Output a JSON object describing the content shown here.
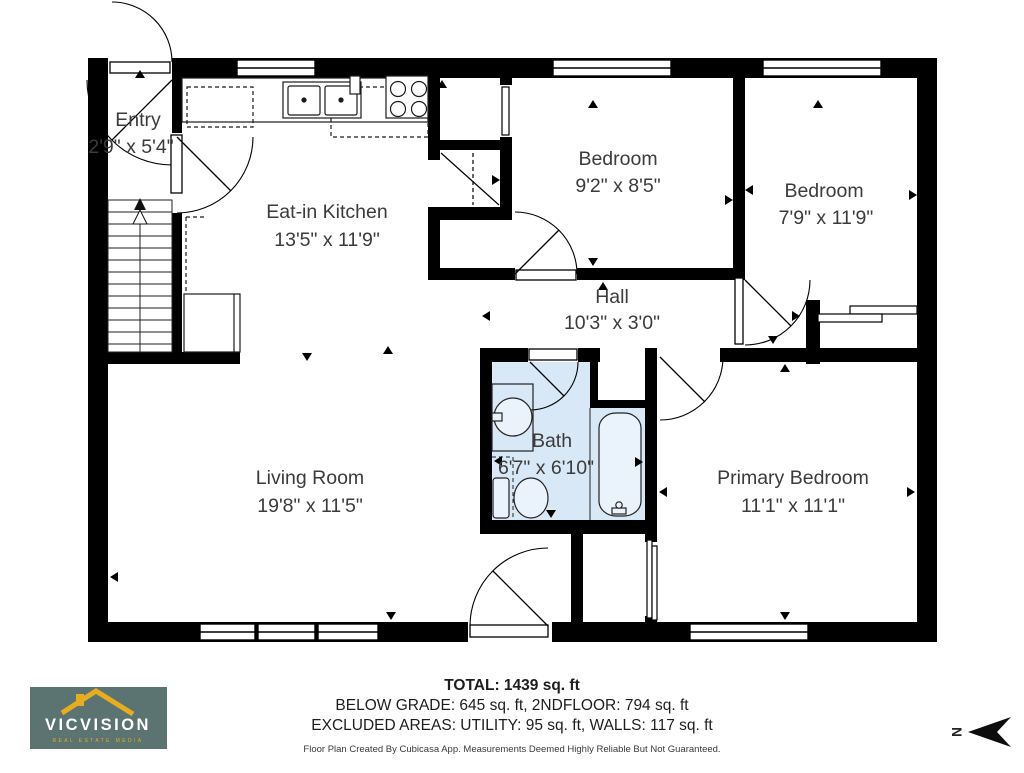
{
  "plan": {
    "rooms": [
      {
        "name": "Entry",
        "dims": "2'9\" x 5'4\""
      },
      {
        "name": "Eat-in Kitchen",
        "dims": "13'5\" x 11'9\""
      },
      {
        "name": "Bedroom",
        "dims": "9'2\" x 8'5\""
      },
      {
        "name": "Bedroom",
        "dims": "7'9\" x 11'9\""
      },
      {
        "name": "Hall",
        "dims": "10'3\" x 3'0\""
      },
      {
        "name": "Bath",
        "dims": "6'7\" x 6'10\""
      },
      {
        "name": "Living Room",
        "dims": "19'8\" x 11'5\""
      },
      {
        "name": "Primary Bedroom",
        "dims": "11'1\" x 11'1\""
      }
    ]
  },
  "footer": {
    "total": "TOTAL: 1439 sq. ft",
    "line2": "BELOW GRADE: 645 sq. ft, 2NDFLOOR: 794 sq. ft",
    "line3": "EXCLUDED AREAS: UTILITY: 95 sq. ft, WALLS: 117 sq. ft",
    "disclaimer": "Floor Plan Created By Cubicasa App. Measurements Deemed Highly Reliable But Not Guaranteed."
  },
  "logo": {
    "brand": "VICVISION",
    "tagline": "REAL ESTATE MEDIA"
  },
  "compass": {
    "label": "N"
  },
  "colors": {
    "wall": "#000000",
    "bath_fill": "#d9e8f6",
    "fixture_fill": "#eaf3fb",
    "logo_bg": "#5b7471",
    "logo_accent": "#e8ad1f",
    "label_text": "#3b3b3b"
  }
}
